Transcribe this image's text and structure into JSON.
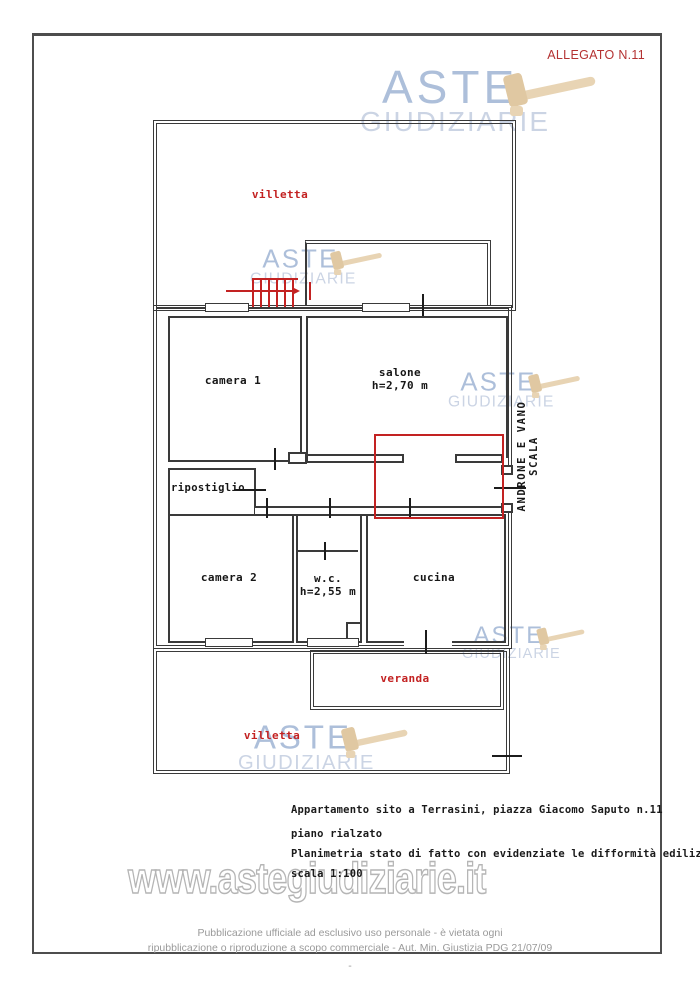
{
  "page": {
    "allegato_label": "ALLEGATO N.11",
    "caption": {
      "line1": "Appartamento sito a Terrasini, piazza Giacomo Saputo n.11",
      "line2": "piano rialzato",
      "line3": "Planimetria stato di fatto con evidenziate le difformità edilizie",
      "line4": "scala 1:100"
    },
    "footer": {
      "line1": "Pubblicazione ufficiale ad esclusivo uso personale - è vietata ogni",
      "line2": "ripubblicazione o riproduzione a scopo commerciale - Aut. Min. Giustizia PDG 21/07/09",
      "dash": "-"
    }
  },
  "floorplan": {
    "labels": {
      "villetta_top": "villetta",
      "camera1": "camera 1",
      "salone": "salone",
      "salone_height": "h=2,70 m",
      "ripostiglio": "ripostiglio",
      "camera2": "camera 2",
      "wc": "w.c.",
      "wc_height": "h=2,55 m",
      "cucina": "cucina",
      "veranda": "veranda",
      "villetta_bottom": "villetta",
      "stairwell": "ANDRONE E VANO SCALA"
    }
  },
  "watermark": {
    "word1": "ASTE",
    "word2": "GIUDIZIARIE",
    "url": "www.astegiudiziarie.it"
  },
  "colors": {
    "highlight_red": "#c32222",
    "wall": "#3a3a3a",
    "wm_blue": "#9fb4d4",
    "wm_blue_light": "#c2cde0",
    "gavel_tan": "#e8d4b4",
    "footer_gray": "#9a9a9a",
    "frame_gray": "#4d4d4d"
  }
}
